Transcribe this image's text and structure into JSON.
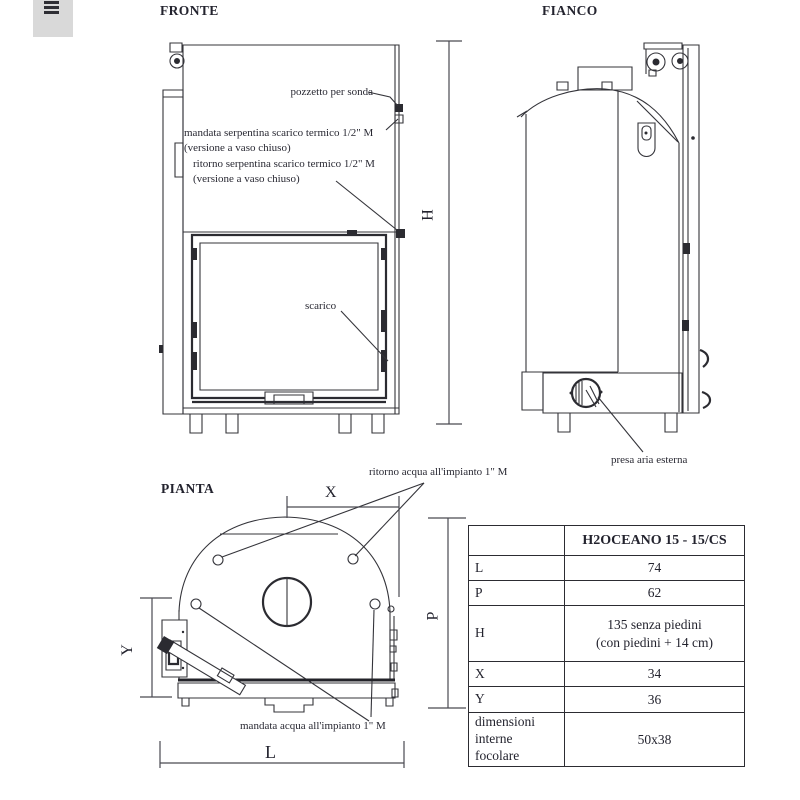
{
  "corner_tab": {
    "icon": "text-lines"
  },
  "views": {
    "front": {
      "title": "FRONTE",
      "dim_label": "H",
      "annotations": {
        "pozzetto": "pozzetto per sonda",
        "mandata_1": "mandata serpentina scarico termico 1/2\" M",
        "mandata_2": "(versione a vaso chiuso)",
        "ritorno_1": "ritorno serpentina scarico termico 1/2\" M",
        "ritorno_2": "(versione a vaso chiuso)",
        "scarico": "scarico"
      }
    },
    "side": {
      "title": "FIANCO",
      "annotations": {
        "presa_aria": "presa aria esterna"
      }
    },
    "plan": {
      "title": "PIANTA",
      "annotations": {
        "ritorno_acqua": "ritorno acqua all'impianto 1\" M",
        "mandata_acqua": "mandata acqua all'impianto 1\" M"
      },
      "dim_labels": {
        "x": "X",
        "y": "Y",
        "p": "P",
        "l": "L"
      }
    }
  },
  "table": {
    "model_header": "H2OCEANO 15 - 15/CS",
    "rows": [
      {
        "label": "L",
        "value": "74"
      },
      {
        "label": "P",
        "value": "62"
      },
      {
        "label": "H",
        "value": "135 senza piedini",
        "value2": "(con piedini + 14 cm)"
      },
      {
        "label": "X",
        "value": "34"
      },
      {
        "label": "Y",
        "value": "36"
      },
      {
        "label": "dimensioni interne focolare",
        "value": "50x38"
      }
    ]
  }
}
